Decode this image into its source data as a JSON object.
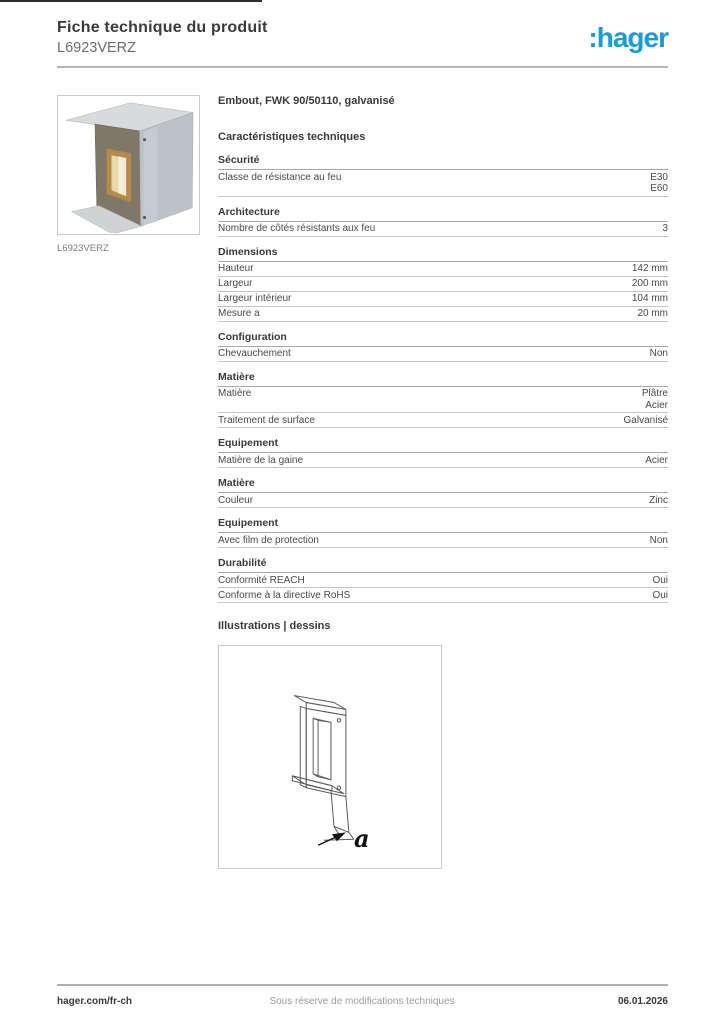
{
  "header": {
    "title": "Fiche technique du produit",
    "subtitle": "L6923VERZ"
  },
  "brand": {
    "logo_text": ":hager",
    "logo_color": "#189cd8"
  },
  "product": {
    "caption": "L6923VERZ",
    "image_name": "galvanized-end-cap-photo"
  },
  "main": {
    "product_title": "Embout, FWK 90/50110, galvanisé",
    "characteristics_heading": "Caractéristiques techniques",
    "sections": [
      {
        "title": "Sécurité",
        "rows": [
          {
            "label": "Classe de résistance au feu",
            "values": [
              "E30",
              "E60"
            ]
          }
        ]
      },
      {
        "title": "Architecture",
        "rows": [
          {
            "label": "Nombre de côtés résistants aux feu",
            "values": [
              "3"
            ]
          }
        ]
      },
      {
        "title": "Dimensions",
        "rows": [
          {
            "label": "Hauteur",
            "values": [
              "142 mm"
            ]
          },
          {
            "label": "Largeur",
            "values": [
              "200 mm"
            ]
          },
          {
            "label": "Largeur intérieur",
            "values": [
              "104 mm"
            ]
          },
          {
            "label": "Mesure a",
            "values": [
              "20 mm"
            ]
          }
        ]
      },
      {
        "title": "Configuration",
        "rows": [
          {
            "label": "Chevauchement",
            "values": [
              "Non"
            ]
          }
        ]
      },
      {
        "title": "Matière",
        "rows": [
          {
            "label": "Matière",
            "values": [
              "Plâtre",
              "Acier"
            ]
          },
          {
            "label": "Traitement de surface",
            "values": [
              "Galvanisé"
            ]
          }
        ]
      },
      {
        "title": "Equipement",
        "rows": [
          {
            "label": "Matière de la gaine",
            "values": [
              "Acier"
            ]
          }
        ]
      },
      {
        "title": "Matière",
        "rows": [
          {
            "label": "Couleur",
            "values": [
              "Zinc"
            ]
          }
        ]
      },
      {
        "title": "Equipement",
        "rows": [
          {
            "label": "Avec film de protection",
            "values": [
              "Non"
            ]
          }
        ]
      },
      {
        "title": "Durabilité",
        "rows": [
          {
            "label": "Conformité REACH",
            "values": [
              "Oui"
            ]
          },
          {
            "label": "Conforme à la directive RoHS",
            "values": [
              "Oui"
            ]
          }
        ]
      }
    ],
    "illustrations_heading": "Illustrations | dessins",
    "illustration": {
      "dimension_label": "a",
      "drawing_name": "end-cap-isometric-drawing"
    }
  },
  "footer": {
    "left": "hager.com/fr-ch",
    "center": "Sous réserve de modifications techniques",
    "right": "06.01.2026"
  }
}
